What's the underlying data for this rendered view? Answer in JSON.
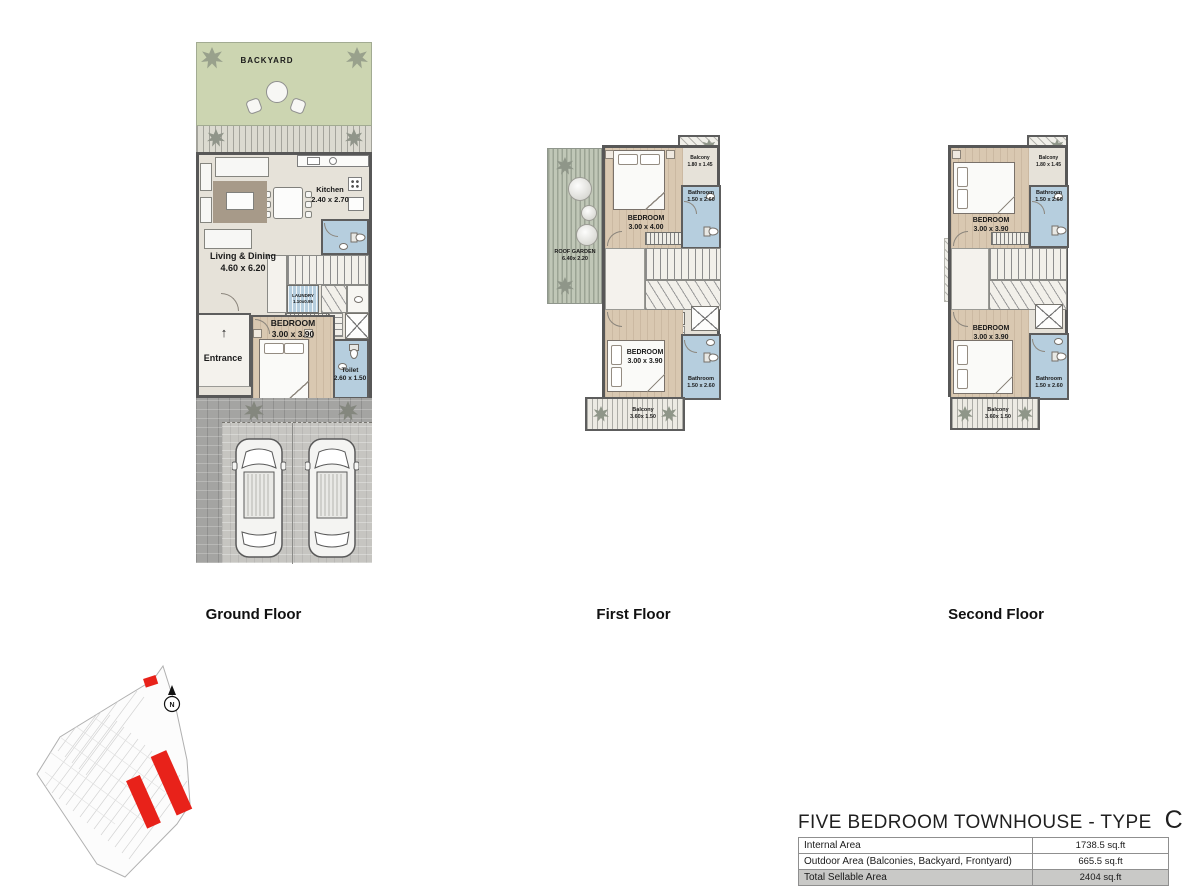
{
  "title": {
    "text": "FIVE BEDROOM TOWNHOUSE - TYPE",
    "type_letter": "C"
  },
  "floor_labels": {
    "ground": "Ground Floor",
    "first": "First Floor",
    "second": "Second Floor"
  },
  "area_table": {
    "rows": [
      {
        "label": "Internal Area",
        "value": "1738.5 sq.ft"
      },
      {
        "label": "Outdoor Area (Balconies, Backyard, Frontyard)",
        "value": "665.5 sq.ft"
      },
      {
        "label": "Total Sellable Area",
        "value": "2404 sq.ft"
      }
    ]
  },
  "floors": {
    "ground": {
      "rooms": {
        "backyard": {
          "name": "BACKYARD"
        },
        "kitchen": {
          "name": "Kitchen",
          "dims": "2.40 x 2.70"
        },
        "living": {
          "name": "Living & Dining",
          "dims": "4.60 x 6.20"
        },
        "laundry": {
          "name": "LAUNDRY",
          "dims": "1.10x0.95"
        },
        "bedroom": {
          "name": "BEDROOM",
          "dims": "3.00 x 3.90"
        },
        "entrance": {
          "name": "Entrance",
          "arrow": "↑"
        },
        "toilet": {
          "name": "Toilet",
          "dims": "2.60 x 1.50"
        }
      }
    },
    "first": {
      "rooms": {
        "roof_garden": {
          "name": "ROOF GARDEN",
          "dims": "6.40x 2.20"
        },
        "balcony_top": {
          "name": "Balcony",
          "dims": "1.80 x 1.45"
        },
        "bathroom_top": {
          "name": "Bathroom",
          "dims": "1.50 x 2.60"
        },
        "bedroom_top": {
          "name": "BEDROOM",
          "dims": "3.00 x 4.00"
        },
        "bedroom_bottom": {
          "name": "BEDROOM",
          "dims": "3.00 x 3.90"
        },
        "bathroom_bottom": {
          "name": "Bathroom",
          "dims": "1.50 x 2.60"
        },
        "balcony_bottom": {
          "name": "Balcony",
          "dims": "3.60x 1.50"
        }
      }
    },
    "second": {
      "rooms": {
        "balcony_top": {
          "name": "Balcony",
          "dims": "1.80 x 1.45"
        },
        "bathroom_top": {
          "name": "Bathroom",
          "dims": "1.50 x 2.60"
        },
        "bedroom_top": {
          "name": "BEDROOM",
          "dims": "3.00 x 3.90"
        },
        "bedroom_bottom": {
          "name": "BEDROOM",
          "dims": "3.00 x 3.90"
        },
        "bathroom_bottom": {
          "name": "Bathroom",
          "dims": "1.50 x 2.60"
        },
        "balcony_bottom": {
          "name": "Balcony",
          "dims": "3.60x 1.50"
        }
      }
    }
  },
  "site_plan": {
    "north_label": "N",
    "highlight_color": "#e8221a"
  },
  "colors": {
    "wall": "#5d5d5d",
    "wood_floor": "#d9c8b1",
    "bathroom_blue": "#b6cede",
    "backyard_green": "#ccd5b1",
    "roof_garden_green": "#c0c7b7",
    "driveway_gray": "#a4a4a2",
    "highlight_red": "#e8221a",
    "table_total_row": "#c9c9c7"
  }
}
